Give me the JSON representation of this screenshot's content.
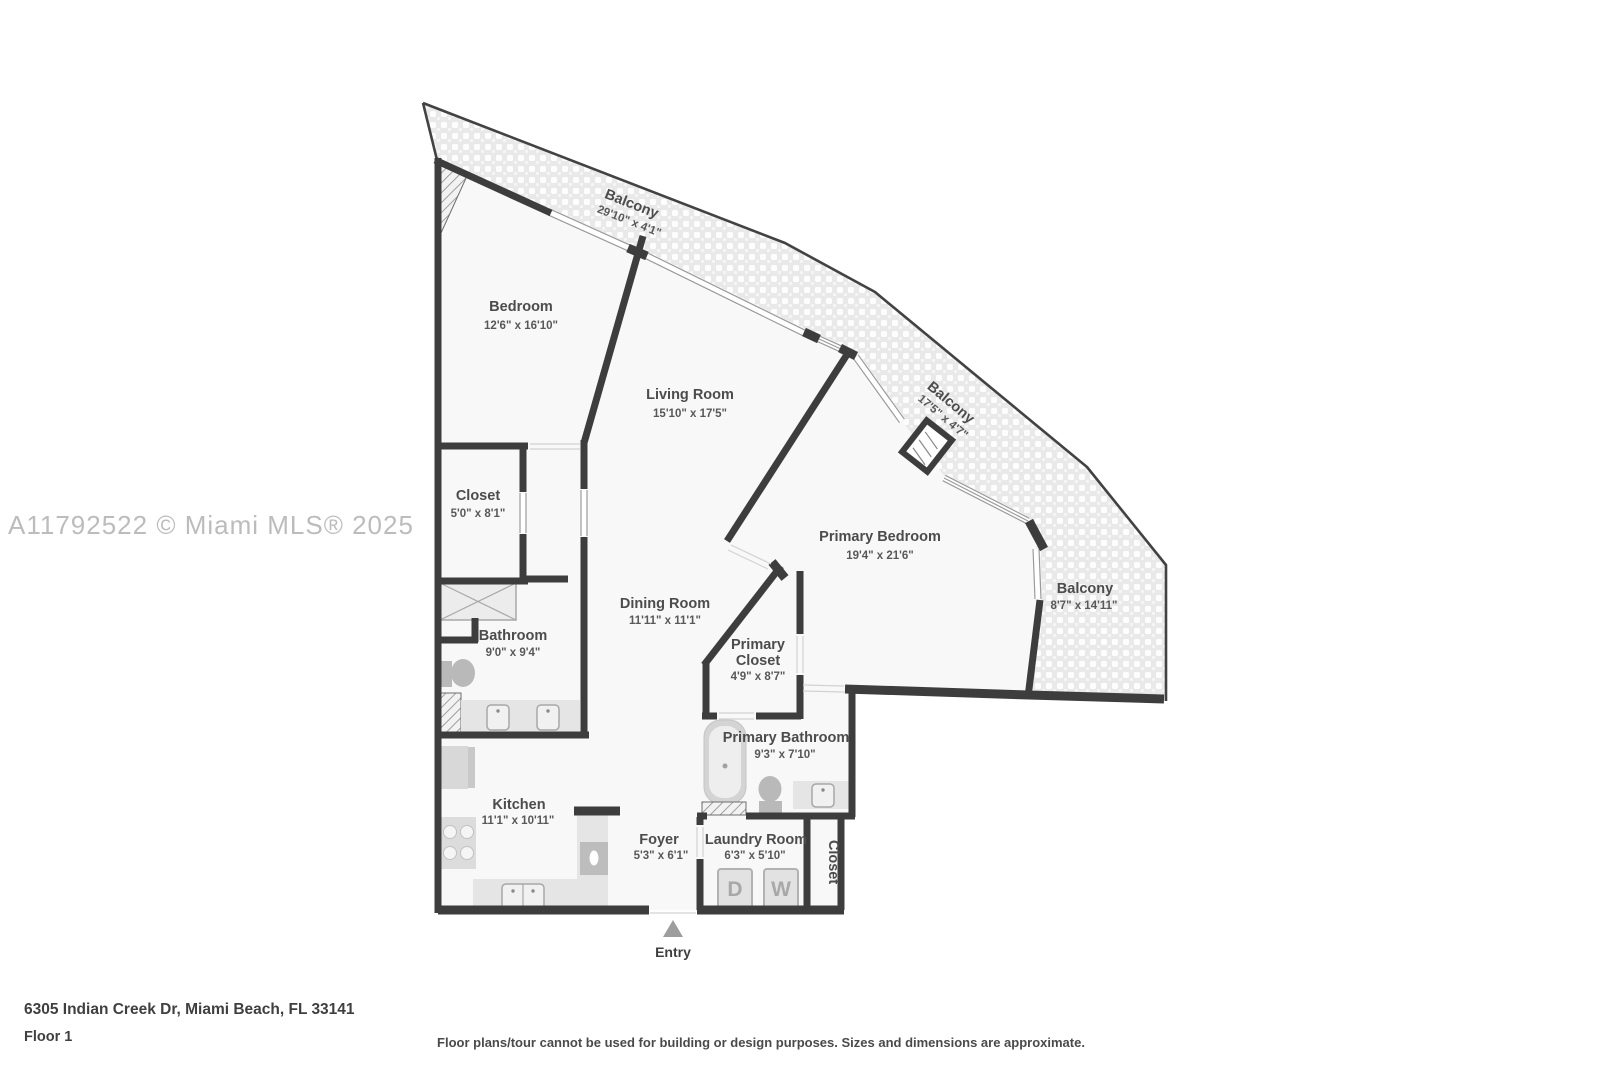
{
  "watermark": "A11792522 © Miami MLS® 2025",
  "rooms": {
    "balcony_top": {
      "name": "Balcony",
      "dims": "29'10\" x 4'1\""
    },
    "bedroom": {
      "name": "Bedroom",
      "dims": "12'6\" x 16'10\""
    },
    "living_room": {
      "name": "Living Room",
      "dims": "15'10\" x 17'5\""
    },
    "balcony_mid": {
      "name": "Balcony",
      "dims": "17'5\" x 4'7\""
    },
    "closet": {
      "name": "Closet",
      "dims": "5'0\" x 8'1\""
    },
    "primary_bedroom": {
      "name": "Primary Bedroom",
      "dims": "19'4\" x 21'6\""
    },
    "balcony_right": {
      "name": "Balcony",
      "dims": "8'7\" x 14'11\""
    },
    "bathroom": {
      "name": "Bathroom",
      "dims": "9'0\" x 9'4\""
    },
    "dining_room": {
      "name": "Dining Room",
      "dims": "11'11\" x 11'1\""
    },
    "primary_closet": {
      "name_line1": "Primary",
      "name_line2": "Closet",
      "dims": "4'9\" x 8'7\""
    },
    "primary_bathroom": {
      "name": "Primary Bathroom",
      "dims": "9'3\" x 7'10\""
    },
    "kitchen": {
      "name": "Kitchen",
      "dims": "11'1\" x 10'11\""
    },
    "foyer": {
      "name": "Foyer",
      "dims": "5'3\" x 6'1\""
    },
    "laundry_room": {
      "name": "Laundry Room",
      "dims": "6'3\" x 5'10\""
    },
    "closet_se": {
      "name": "Closet"
    }
  },
  "laundry": {
    "dryer_label": "D",
    "washer_label": "W"
  },
  "entry_label": "Entry",
  "footer": {
    "address": "6305 Indian Creek Dr, Miami Beach, FL 33141",
    "floor": "Floor 1",
    "disclaimer": "Floor plans/tour cannot be used for building or design purposes. Sizes and dimensions are approximate."
  },
  "colors": {
    "wall": "#3d3d3d",
    "label": "#4c4c4c",
    "balcony_base": "#e9e9e9",
    "interior": "#f8f8f8",
    "fixture": "#b9b9b9",
    "watermark": "#bcbcbc"
  }
}
